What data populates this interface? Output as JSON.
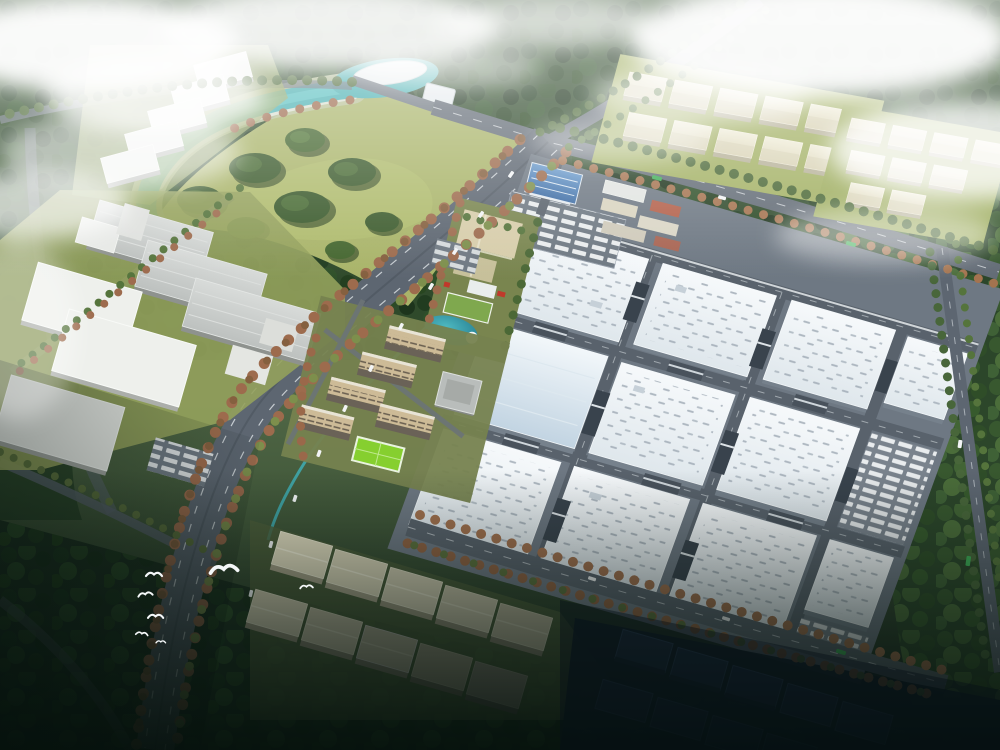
{
  "image": {
    "kind": "aerial architectural rendering",
    "subject": "Bird's-eye masterplan rendering of an industrial park: a large factory campus with white-blue roofed halls, an entrance gate with blue roof, truck parking, a landscaped amenity strip with pond, beige residential towers with a bright green sports field, a teal river and wooded park, clusters of cream warehouses in forest, tree-lined boulevards, flying white birds, low clouds and haze, with the foreground falling into dark shadow",
    "time_of_day": "daytime with low clouds and mist"
  },
  "palette": {
    "fog_white": "#f0f4f5",
    "forest_dark": "#24381f",
    "forest_mid": "#3a5531",
    "lawn_yellow_green": "#a9b469",
    "river_teal": "#49b0b2",
    "pond_teal": "#2e93a4",
    "road_grey": "#5d6671",
    "lane_white": "#e8edf0",
    "factory_roof": "#e2e9ee",
    "factory_roof_blue": "#c2d4e2",
    "factory_wall": "#76818c",
    "cream_warehouse": "#eae6cf",
    "grey_hall": "#c9cdcb",
    "white_warehouse": "#eef0ec",
    "residential_beige": "#cdbb97",
    "sports_field_green": "#86cf2f",
    "gate_roof_blue": "#4a7eb3",
    "autumn_tree": "#9d6b4d",
    "green_tree": "#4b6836",
    "dark_warehouse": "#27374e",
    "shadow_navy": "#0a1511",
    "bird_white": "#f4f7f8",
    "bus_green": "#3fae57"
  },
  "zones": [
    {
      "name": "river-and-park",
      "label": "teal river, white island, wooded park lawn"
    },
    {
      "name": "west-industrial-area",
      "label": "grey ridged halls and white warehouses"
    },
    {
      "name": "northwest-warehouse-row",
      "label": "five white warehouses in a diagonal row"
    },
    {
      "name": "northeast-warehouse-clusters",
      "label": "two clusters of cream gabled warehouses in forest"
    },
    {
      "name": "factory-campus",
      "label": "main campus of twelve large factory halls with truck yards"
    },
    {
      "name": "entrance-gate",
      "label": "blue-roofed campus gate with trailer parking"
    },
    {
      "name": "amenity-strip",
      "label": "landscaped courtyard with pond and green-roof building"
    },
    {
      "name": "residential-cluster",
      "label": "five beige mid-rise towers with sports field"
    },
    {
      "name": "main-boulevard",
      "label": "wide tree-lined boulevard running to lower left"
    },
    {
      "name": "south-warehouse-rows",
      "label": "cream warehouses fading into shadow"
    },
    {
      "name": "southeast-dark-warehouses",
      "label": "warehouses in deep shadow"
    },
    {
      "name": "bird-flock",
      "label": "white birds in flight"
    },
    {
      "name": "clouds",
      "label": "low white clouds and haze"
    }
  ]
}
